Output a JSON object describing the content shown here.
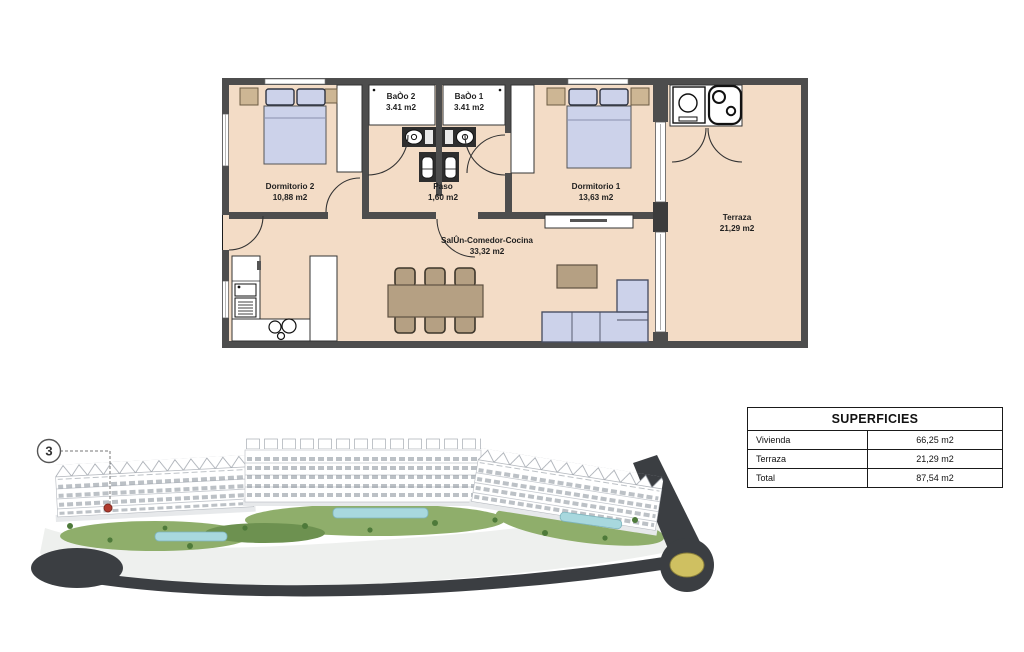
{
  "floor_plan": {
    "rooms": [
      {
        "id": "dormitorio-2",
        "name": "Dormitorio 2",
        "area": "10,88 m2"
      },
      {
        "id": "bano-2",
        "name": "BaÒo 2",
        "area": "3.41 m2"
      },
      {
        "id": "bano-1",
        "name": "BaÒo 1",
        "area": "3.41 m2"
      },
      {
        "id": "paso",
        "name": "Paso",
        "area": "1,60 m2"
      },
      {
        "id": "dormitorio-1",
        "name": "Dormitorio 1",
        "area": "13,63 m2"
      },
      {
        "id": "salon",
        "name": "SalÛn-Comedor-Cocina",
        "area": "33,32 m2"
      },
      {
        "id": "terraza",
        "name": "Terraza",
        "area": "21,29 m2"
      }
    ],
    "colors": {
      "floor": "#f3dcc6",
      "wall": "#4d4d4d",
      "bed": "#ccd2ea",
      "wood": "#b5a083"
    }
  },
  "site_plan": {
    "unit_badge": "3",
    "marker_color": "#b03a2e",
    "roundabout_color": "#cfc061",
    "pool_color": "#a8d8de",
    "road_color": "#3b3e42"
  },
  "surfaces_table": {
    "title": "SUPERFICIES",
    "rows": [
      {
        "label": "Vivienda",
        "value": "66,25 m2"
      },
      {
        "label": "Terraza",
        "value": "21,29 m2"
      },
      {
        "label": "Total",
        "value": "87,54 m2"
      }
    ]
  }
}
